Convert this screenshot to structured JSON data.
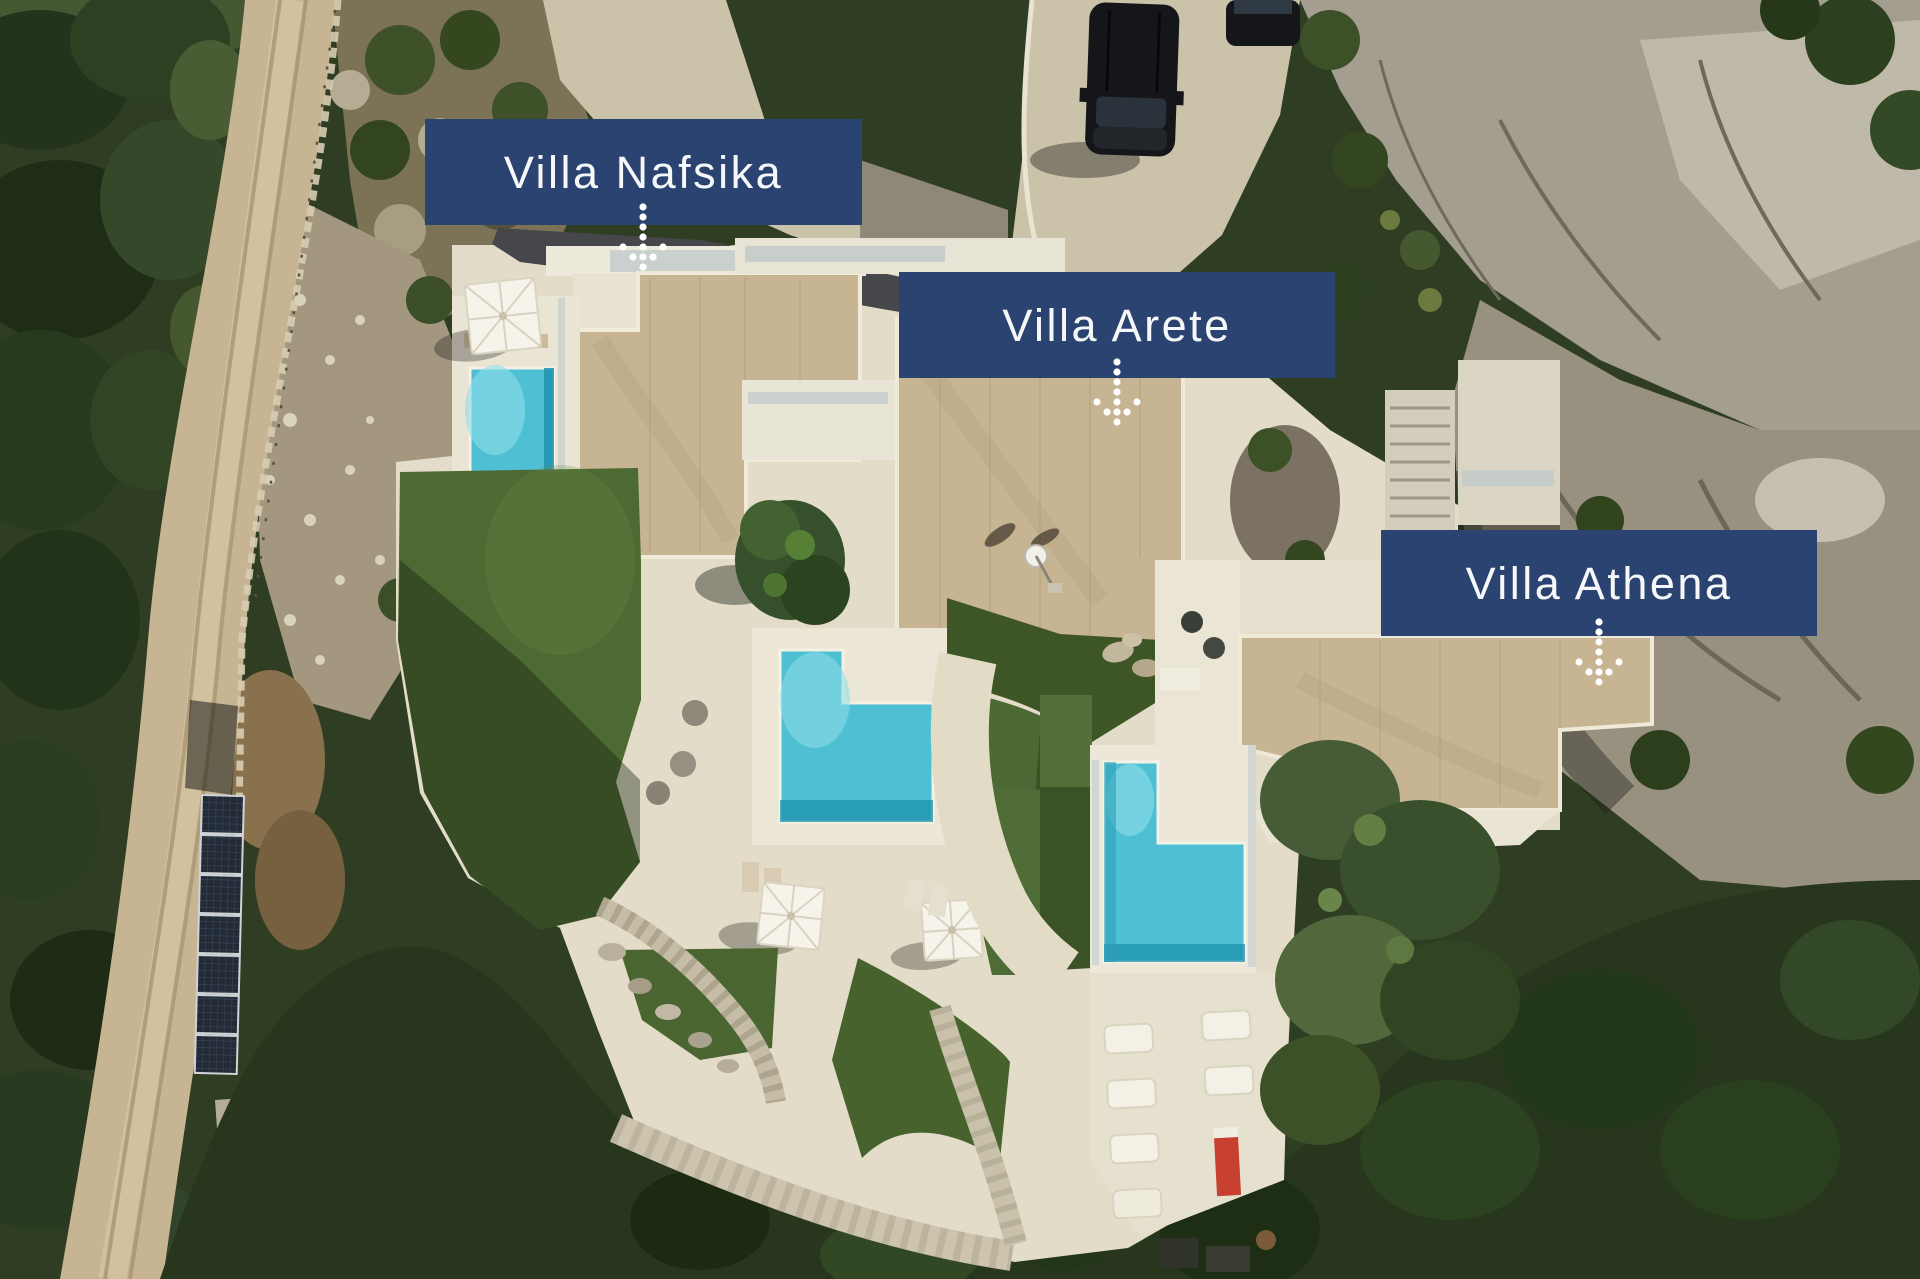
{
  "overlays": {
    "villas": [
      {
        "id": "nafsika",
        "label": "Villa Nafsika"
      },
      {
        "id": "arete",
        "label": "Villa Arete"
      },
      {
        "id": "athena",
        "label": "Villa Athena"
      }
    ]
  },
  "icons": {
    "arrow": "dotted-down-arrow"
  },
  "colors": {
    "banner_bg": "#2B4370",
    "banner_text": "#F6F7F9",
    "arrow_dots": "#FFFFFF",
    "pool_water": "#4FC0D4",
    "lawn": "#4E6A33",
    "roof_beige": "#C6B493",
    "terrace_white": "#E9E4D4",
    "concrete_drive": "#CBC2AA",
    "dirt_road": "#C7B492",
    "rock_gray": "#A49E90",
    "forest_green": "#2F3E23",
    "solar_panel": "#232B37",
    "car_black": "#141619"
  }
}
